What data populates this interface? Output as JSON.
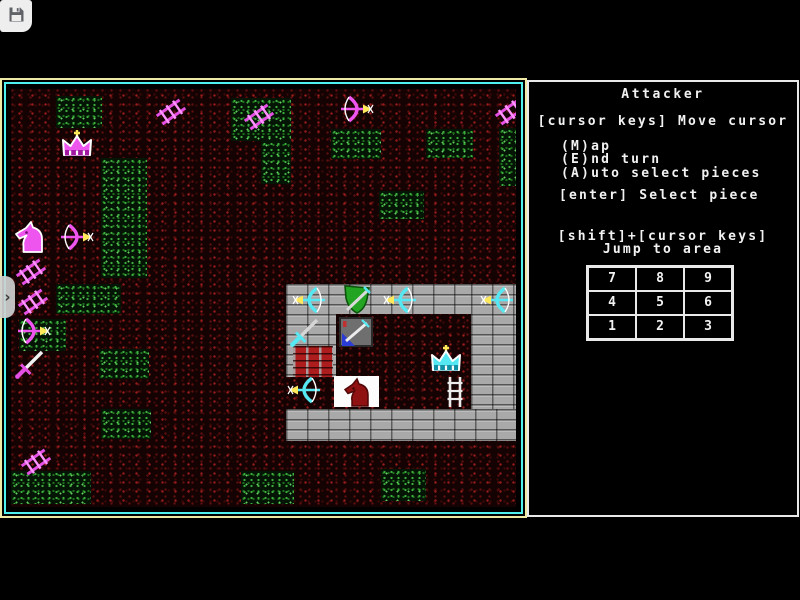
{
  "toolbar": {
    "save_button": {
      "icon": "floppy-disk"
    }
  },
  "drawer_tab": {
    "chevron": "›"
  },
  "panel": {
    "border_color": "#e9e9e9",
    "title": "Attacker",
    "instructions": {
      "move": "[cursor keys] Move cursor",
      "map": "(M)ap",
      "end": "(E)nd turn",
      "auto": "(A)uto select pieces",
      "select": "[enter] Select piece",
      "jump_combo": "[shift]+[cursor keys]",
      "jump_label": "Jump to area"
    },
    "jump_grid": {
      "cells": [
        "7",
        "8",
        "9",
        "4",
        "5",
        "6",
        "1",
        "2",
        "3"
      ]
    }
  },
  "game": {
    "map": {
      "border_outer": "#efe9a6",
      "border_inner": "#4ef0f0",
      "terrain_base": "#150303",
      "terrain_speck": "#9a1d1d",
      "grass_base": "#051505",
      "grass_speck": "#3dad3d",
      "piece_magenta": "#ee55ee",
      "piece_cyan": "#56e8f2",
      "arrow_yellow": "#ffe95a",
      "green_patches": [
        [
          45,
          7,
          46,
          32
        ],
        [
          220,
          9,
          60,
          43
        ],
        [
          250,
          52,
          30,
          43
        ],
        [
          320,
          40,
          50,
          30
        ],
        [
          415,
          40,
          47,
          29
        ],
        [
          488,
          39,
          30,
          58
        ],
        [
          368,
          102,
          45,
          28
        ],
        [
          90,
          69,
          46,
          120
        ],
        [
          45,
          195,
          65,
          30
        ],
        [
          8,
          230,
          47,
          32
        ],
        [
          88,
          260,
          50,
          30
        ],
        [
          90,
          320,
          50,
          30
        ],
        [
          0,
          382,
          80,
          33
        ],
        [
          230,
          382,
          53,
          33
        ],
        [
          370,
          380,
          45,
          32
        ]
      ],
      "objects": [
        {
          "type": "ladder",
          "x": 148,
          "y": 8,
          "rot": 55,
          "name": "siege-ladder-icon",
          "i": false
        },
        {
          "type": "ladder",
          "x": 236,
          "y": 13,
          "rot": 55,
          "name": "siege-ladder-icon",
          "i": false
        },
        {
          "type": "ladder",
          "x": 487,
          "y": 8,
          "rot": 55,
          "name": "siege-ladder-icon",
          "i": false
        },
        {
          "type": "ladder",
          "x": 8,
          "y": 168,
          "rot": 55,
          "name": "siege-ladder-icon",
          "i": false
        },
        {
          "type": "ladder",
          "x": 10,
          "y": 198,
          "rot": 55,
          "name": "siege-ladder-icon",
          "i": false
        },
        {
          "type": "ladder",
          "x": 13,
          "y": 358,
          "rot": 55,
          "name": "siege-ladder-icon",
          "i": false
        },
        {
          "type": "crown",
          "palette": "magenta",
          "x": 48,
          "y": 40,
          "name": "attacker-king-piece",
          "i": true
        },
        {
          "type": "knight",
          "x": 2,
          "y": 132,
          "name": "attacker-knight-piece",
          "i": true
        },
        {
          "type": "bow",
          "palette": "magenta",
          "dir": "right",
          "x": 48,
          "y": 134,
          "name": "attacker-archer-piece",
          "i": true
        },
        {
          "type": "bow",
          "palette": "magenta",
          "dir": "right",
          "x": 328,
          "y": 6,
          "name": "attacker-archer-piece",
          "i": true
        },
        {
          "type": "bow",
          "palette": "magenta",
          "dir": "right",
          "x": 5,
          "y": 228,
          "name": "attacker-archer-piece",
          "i": true
        },
        {
          "type": "sword",
          "palette": "magenta",
          "x": 2,
          "y": 260,
          "name": "attacker-sword-piece",
          "i": true
        }
      ],
      "castle": {
        "x": 275,
        "y": 195,
        "w": 235,
        "h": 157,
        "walls": [
          {
            "kind": "gray",
            "x": 0,
            "y": 0,
            "w": 235,
            "h": 30
          },
          {
            "kind": "gray",
            "x": 0,
            "y": 125,
            "w": 235,
            "h": 32
          },
          {
            "kind": "gray",
            "x": 185,
            "y": 0,
            "w": 50,
            "h": 125
          },
          {
            "kind": "gray",
            "x": 0,
            "y": 30,
            "w": 50,
            "h": 63
          },
          {
            "kind": "red",
            "x": 7,
            "y": 62,
            "w": 40,
            "h": 31
          }
        ],
        "pieces": [
          {
            "type": "bow",
            "palette": "cyan",
            "dir": "left",
            "x": 5,
            "y": 2,
            "name": "defender-archer-piece",
            "i": true
          },
          {
            "type": "shield",
            "x": 52,
            "y": 0,
            "name": "defender-shield-piece",
            "i": true
          },
          {
            "type": "bow",
            "palette": "cyan",
            "dir": "left",
            "x": 96,
            "y": 2,
            "name": "defender-archer-piece",
            "i": true
          },
          {
            "type": "bow",
            "palette": "cyan",
            "dir": "left",
            "x": 193,
            "y": 2,
            "name": "defender-archer-piece",
            "i": true
          },
          {
            "type": "sword",
            "palette": "steel",
            "x": 2,
            "y": 33,
            "name": "defender-sword-piece",
            "i": true
          },
          {
            "type": "armory",
            "x": 53,
            "y": 33,
            "name": "armory-tile",
            "i": false
          },
          {
            "type": "crown",
            "palette": "cyan",
            "x": 142,
            "y": 60,
            "name": "defender-king-piece",
            "i": true
          },
          {
            "type": "bow",
            "palette": "cyan",
            "dir": "left",
            "x": 0,
            "y": 92,
            "name": "defender-archer-piece",
            "i": true
          },
          {
            "type": "horse_tile",
            "x": 48,
            "y": 92,
            "name": "defender-knight-piece",
            "i": true
          },
          {
            "type": "ladder_w",
            "x": 158,
            "y": 92,
            "name": "castle-ladder-icon",
            "i": false
          }
        ]
      }
    }
  }
}
